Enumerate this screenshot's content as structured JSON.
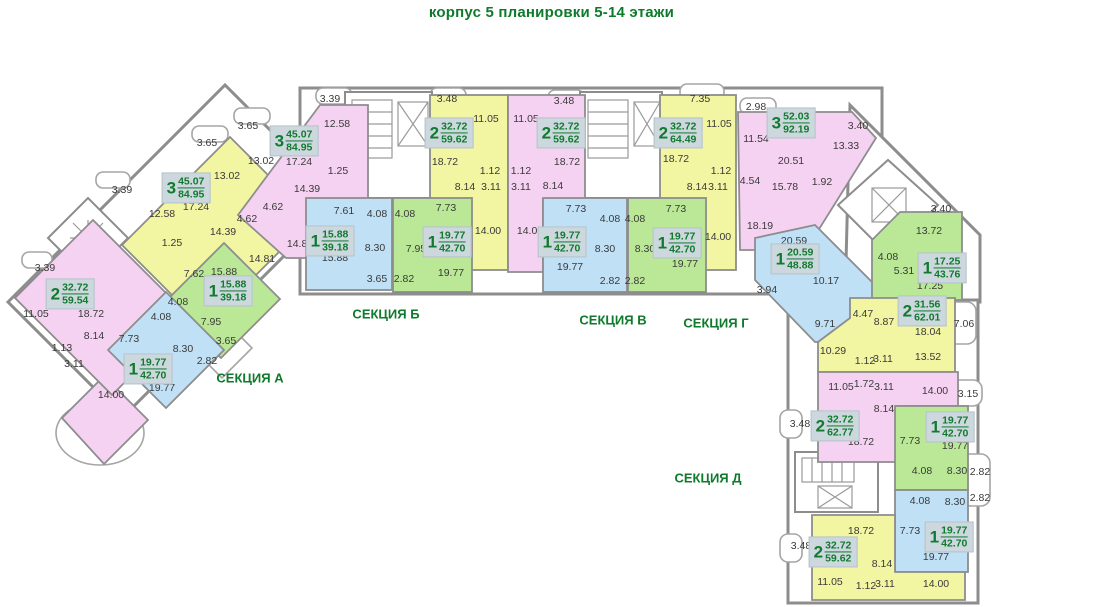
{
  "title": "корпус 5 планировки 5-14 этажи",
  "colors": {
    "accent_green": "#0e7a2b",
    "badge_background": "#ccd8dd",
    "apartment_pink": "#f6d2f2",
    "apartment_yellow": "#f2f5a2",
    "apartment_green": "#bae897",
    "apartment_blue": "#c0e0f6",
    "label_gray": "#3a3a3a",
    "wall_gray": "#8d8d8d"
  },
  "sections": [
    {
      "label": "СЕКЦИЯ А",
      "x": 250,
      "y": 378
    },
    {
      "label": "СЕКЦИЯ Б",
      "x": 386,
      "y": 314
    },
    {
      "label": "СЕКЦИЯ В",
      "x": 613,
      "y": 320
    },
    {
      "label": "СЕКЦИЯ Г",
      "x": 716,
      "y": 323
    },
    {
      "label": "СЕКЦИЯ Д",
      "x": 708,
      "y": 478
    }
  ],
  "apartments": [
    {
      "rooms": "2",
      "living": "32.72",
      "total": "59.54",
      "x": 70,
      "y": 294
    },
    {
      "rooms": "1",
      "living": "19.77",
      "total": "42.70",
      "x": 148,
      "y": 369
    },
    {
      "rooms": "1",
      "living": "15.88",
      "total": "39.18",
      "x": 228,
      "y": 291
    },
    {
      "rooms": "3",
      "living": "45.07",
      "total": "84.95",
      "x": 186,
      "y": 188
    },
    {
      "rooms": "3",
      "living": "45.07",
      "total": "84.95",
      "x": 294,
      "y": 141
    },
    {
      "rooms": "2",
      "living": "32.72",
      "total": "59.62",
      "x": 449,
      "y": 133
    },
    {
      "rooms": "1",
      "living": "15.88",
      "total": "39.18",
      "x": 330,
      "y": 241
    },
    {
      "rooms": "1",
      "living": "19.77",
      "total": "42.70",
      "x": 447,
      "y": 242
    },
    {
      "rooms": "2",
      "living": "32.72",
      "total": "59.62",
      "x": 561,
      "y": 133
    },
    {
      "rooms": "1",
      "living": "19.77",
      "total": "42.70",
      "x": 562,
      "y": 242
    },
    {
      "rooms": "1",
      "living": "19.77",
      "total": "42.70",
      "x": 677,
      "y": 243
    },
    {
      "rooms": "2",
      "living": "32.72",
      "total": "64.49",
      "x": 678,
      "y": 133
    },
    {
      "rooms": "3",
      "living": "52.03",
      "total": "92.19",
      "x": 791,
      "y": 123
    },
    {
      "rooms": "1",
      "living": "20.59",
      "total": "48.88",
      "x": 795,
      "y": 259
    },
    {
      "rooms": "1",
      "living": "17.25",
      "total": "43.76",
      "x": 942,
      "y": 268
    },
    {
      "rooms": "2",
      "living": "31.56",
      "total": "62.01",
      "x": 922,
      "y": 311
    },
    {
      "rooms": "2",
      "living": "32.72",
      "total": "62.77",
      "x": 835,
      "y": 426
    },
    {
      "rooms": "1",
      "living": "19.77",
      "total": "42.70",
      "x": 950,
      "y": 427
    },
    {
      "rooms": "1",
      "living": "19.77",
      "total": "42.70",
      "x": 949,
      "y": 537
    },
    {
      "rooms": "2",
      "living": "32.72",
      "total": "59.62",
      "x": 833,
      "y": 552
    }
  ],
  "area_labels": [
    {
      "v": "3.39",
      "x": 122,
      "y": 190
    },
    {
      "v": "3.39",
      "x": 45,
      "y": 268
    },
    {
      "v": "3.65",
      "x": 207,
      "y": 143
    },
    {
      "v": "3.65",
      "x": 248,
      "y": 126
    },
    {
      "v": "12.58",
      "x": 162,
      "y": 214
    },
    {
      "v": "17.24",
      "x": 196,
      "y": 207
    },
    {
      "v": "13.02",
      "x": 227,
      "y": 176
    },
    {
      "v": "14.39",
      "x": 223,
      "y": 232
    },
    {
      "v": "1.25",
      "x": 172,
      "y": 243
    },
    {
      "v": "14.81",
      "x": 262,
      "y": 259
    },
    {
      "v": "11.05",
      "x": 36,
      "y": 314
    },
    {
      "v": "18.72",
      "x": 91,
      "y": 314
    },
    {
      "v": "8.14",
      "x": 94,
      "y": 336
    },
    {
      "v": "1.13",
      "x": 62,
      "y": 348
    },
    {
      "v": "3.11",
      "x": 74,
      "y": 364
    },
    {
      "v": "14.00",
      "x": 111,
      "y": 395
    },
    {
      "v": "7.73",
      "x": 129,
      "y": 339
    },
    {
      "v": "4.08",
      "x": 161,
      "y": 317
    },
    {
      "v": "4.08",
      "x": 178,
      "y": 302
    },
    {
      "v": "8.30",
      "x": 183,
      "y": 349
    },
    {
      "v": "19.77",
      "x": 162,
      "y": 388
    },
    {
      "v": "7.62",
      "x": 194,
      "y": 274
    },
    {
      "v": "15.88",
      "x": 224,
      "y": 272
    },
    {
      "v": "7.95",
      "x": 211,
      "y": 322
    },
    {
      "v": "3.65",
      "x": 226,
      "y": 341
    },
    {
      "v": "2.82",
      "x": 207,
      "y": 361
    },
    {
      "v": "12.58",
      "x": 337,
      "y": 124
    },
    {
      "v": "13.02",
      "x": 261,
      "y": 161
    },
    {
      "v": "17.24",
      "x": 299,
      "y": 162
    },
    {
      "v": "14.39",
      "x": 307,
      "y": 189
    },
    {
      "v": "4.62",
      "x": 273,
      "y": 207
    },
    {
      "v": "4.62",
      "x": 247,
      "y": 219
    },
    {
      "v": "14.81",
      "x": 300,
      "y": 244
    },
    {
      "v": "1.25",
      "x": 338,
      "y": 171
    },
    {
      "v": "3.39",
      "x": 330,
      "y": 99
    },
    {
      "v": "3.48",
      "x": 447,
      "y": 99
    },
    {
      "v": "11.05",
      "x": 486,
      "y": 119
    },
    {
      "v": "18.72",
      "x": 445,
      "y": 162
    },
    {
      "v": "8.14",
      "x": 465,
      "y": 187
    },
    {
      "v": "1.12",
      "x": 490,
      "y": 171
    },
    {
      "v": "3.11",
      "x": 491,
      "y": 187
    },
    {
      "v": "14.00",
      "x": 488,
      "y": 231
    },
    {
      "v": "7.61",
      "x": 344,
      "y": 211
    },
    {
      "v": "15.88",
      "x": 335,
      "y": 258
    },
    {
      "v": "4.08",
      "x": 377,
      "y": 214
    },
    {
      "v": "8.30",
      "x": 375,
      "y": 248
    },
    {
      "v": "4.08",
      "x": 405,
      "y": 214
    },
    {
      "v": "7.73",
      "x": 446,
      "y": 208
    },
    {
      "v": "7.95",
      "x": 416,
      "y": 249
    },
    {
      "v": "19.77",
      "x": 451,
      "y": 273
    },
    {
      "v": "3.65",
      "x": 377,
      "y": 279
    },
    {
      "v": "2.82",
      "x": 404,
      "y": 279
    },
    {
      "v": "3.48",
      "x": 564,
      "y": 101
    },
    {
      "v": "11.05",
      "x": 526,
      "y": 119
    },
    {
      "v": "1.12",
      "x": 521,
      "y": 171
    },
    {
      "v": "3.11",
      "x": 521,
      "y": 187
    },
    {
      "v": "18.72",
      "x": 567,
      "y": 162
    },
    {
      "v": "8.14",
      "x": 553,
      "y": 186
    },
    {
      "v": "14.00",
      "x": 530,
      "y": 231
    },
    {
      "v": "7.73",
      "x": 576,
      "y": 209
    },
    {
      "v": "4.08",
      "x": 610,
      "y": 219
    },
    {
      "v": "8.30",
      "x": 605,
      "y": 249
    },
    {
      "v": "19.77",
      "x": 570,
      "y": 267
    },
    {
      "v": "2.82",
      "x": 610,
      "y": 281
    },
    {
      "v": "2.82",
      "x": 635,
      "y": 281
    },
    {
      "v": "7.35",
      "x": 700,
      "y": 99
    },
    {
      "v": "7.73",
      "x": 676,
      "y": 209
    },
    {
      "v": "4.08",
      "x": 635,
      "y": 219
    },
    {
      "v": "8.30",
      "x": 645,
      "y": 249
    },
    {
      "v": "19.77",
      "x": 685,
      "y": 264
    },
    {
      "v": "18.72",
      "x": 676,
      "y": 159
    },
    {
      "v": "11.05",
      "x": 719,
      "y": 124
    },
    {
      "v": "8.14",
      "x": 697,
      "y": 187
    },
    {
      "v": "1.12",
      "x": 721,
      "y": 171
    },
    {
      "v": "3.11",
      "x": 718,
      "y": 187
    },
    {
      "v": "14.00",
      "x": 718,
      "y": 237
    },
    {
      "v": "2.98",
      "x": 756,
      "y": 107
    },
    {
      "v": "11.54",
      "x": 756,
      "y": 139
    },
    {
      "v": "20.51",
      "x": 791,
      "y": 161
    },
    {
      "v": "13.33",
      "x": 846,
      "y": 146
    },
    {
      "v": "3.40",
      "x": 858,
      "y": 126
    },
    {
      "v": "4.54",
      "x": 750,
      "y": 181
    },
    {
      "v": "15.78",
      "x": 785,
      "y": 187
    },
    {
      "v": "1.92",
      "x": 822,
      "y": 182
    },
    {
      "v": "18.19",
      "x": 760,
      "y": 226
    },
    {
      "v": "3.40",
      "x": 941,
      "y": 209
    },
    {
      "v": "20.59",
      "x": 794,
      "y": 241
    },
    {
      "v": "10.17",
      "x": 826,
      "y": 281
    },
    {
      "v": "9.71",
      "x": 825,
      "y": 324
    },
    {
      "v": "4.47",
      "x": 863,
      "y": 314
    },
    {
      "v": "3.94",
      "x": 767,
      "y": 290
    },
    {
      "v": "13.72",
      "x": 929,
      "y": 231
    },
    {
      "v": "4.08",
      "x": 888,
      "y": 257
    },
    {
      "v": "5.31",
      "x": 904,
      "y": 271
    },
    {
      "v": "17.25",
      "x": 930,
      "y": 286
    },
    {
      "v": "8.87",
      "x": 884,
      "y": 322
    },
    {
      "v": "10.29",
      "x": 833,
      "y": 351
    },
    {
      "v": "1.12",
      "x": 865,
      "y": 361
    },
    {
      "v": "3.11",
      "x": 883,
      "y": 359
    },
    {
      "v": "18.04",
      "x": 928,
      "y": 332
    },
    {
      "v": "13.52",
      "x": 928,
      "y": 357
    },
    {
      "v": "7.06",
      "x": 964,
      "y": 324
    },
    {
      "v": "11.05",
      "x": 841,
      "y": 387
    },
    {
      "v": "1.72",
      "x": 864,
      "y": 384
    },
    {
      "v": "3.11",
      "x": 884,
      "y": 387
    },
    {
      "v": "8.14",
      "x": 884,
      "y": 409
    },
    {
      "v": "18.72",
      "x": 861,
      "y": 442
    },
    {
      "v": "14.00",
      "x": 935,
      "y": 391
    },
    {
      "v": "3.15",
      "x": 968,
      "y": 394
    },
    {
      "v": "3.48",
      "x": 800,
      "y": 424
    },
    {
      "v": "7.73",
      "x": 910,
      "y": 441
    },
    {
      "v": "19.77",
      "x": 955,
      "y": 446
    },
    {
      "v": "4.08",
      "x": 922,
      "y": 471
    },
    {
      "v": "8.30",
      "x": 957,
      "y": 471
    },
    {
      "v": "2.82",
      "x": 980,
      "y": 472
    },
    {
      "v": "4.08",
      "x": 920,
      "y": 501
    },
    {
      "v": "8.30",
      "x": 955,
      "y": 502
    },
    {
      "v": "2.82",
      "x": 980,
      "y": 498
    },
    {
      "v": "7.73",
      "x": 910,
      "y": 531
    },
    {
      "v": "19.77",
      "x": 936,
      "y": 557
    },
    {
      "v": "3.48",
      "x": 801,
      "y": 546
    },
    {
      "v": "18.72",
      "x": 861,
      "y": 531
    },
    {
      "v": "11.05",
      "x": 830,
      "y": 582
    },
    {
      "v": "8.14",
      "x": 882,
      "y": 564
    },
    {
      "v": "1.12",
      "x": 866,
      "y": 586
    },
    {
      "v": "3.11",
      "x": 885,
      "y": 584
    },
    {
      "v": "14.00",
      "x": 936,
      "y": 584
    }
  ]
}
